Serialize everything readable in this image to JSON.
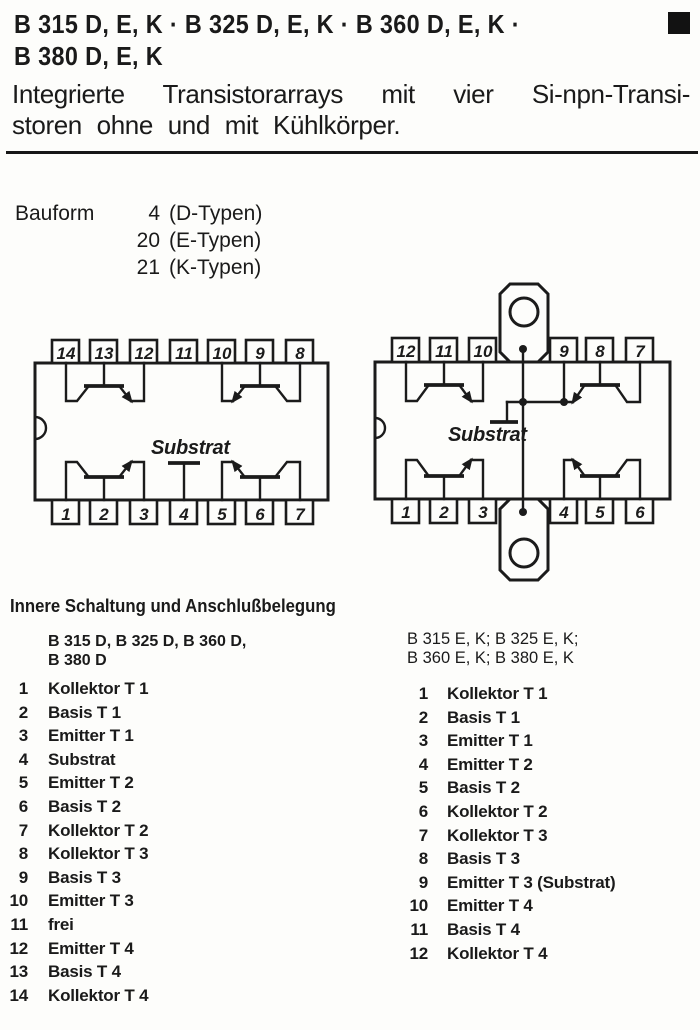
{
  "header": {
    "title_line1": "B 315 D, E, K · B 325 D, E, K · B 360 D, E, K ·",
    "title_line2": "B 380 D, E, K",
    "subtitle_line1": "Integrierte Transistorarrays mit vier Si-npn-Transi-",
    "subtitle_line2": "storen ohne und mit Kühlkörper."
  },
  "bauform": {
    "label": "Bauform",
    "rows": [
      {
        "num": "4",
        "type": "(D-Typen)"
      },
      {
        "num": "20",
        "type": "(E-Typen)"
      },
      {
        "num": "21",
        "type": "(K-Typen)"
      }
    ]
  },
  "diagram_d": {
    "top_pins": [
      "14",
      "13",
      "12",
      "11",
      "10",
      "9",
      "8"
    ],
    "bottom_pins": [
      "1",
      "2",
      "3",
      "4",
      "5",
      "6",
      "7"
    ],
    "substrat_label": "Substrat"
  },
  "diagram_ek": {
    "top_pins": [
      "12",
      "11",
      "10",
      "9",
      "8",
      "7"
    ],
    "bottom_pins": [
      "1",
      "2",
      "3",
      "4",
      "5",
      "6"
    ],
    "substrat_label": "Substrat"
  },
  "pinout": {
    "heading": "Innere Schaltung und Anschlußbelegung",
    "left_column": {
      "header_line1": "B 315 D, B 325 D, B 360 D,",
      "header_line2": "B 380 D",
      "pins": [
        {
          "num": "1",
          "label": "Kollektor T 1"
        },
        {
          "num": "2",
          "label": "Basis T 1"
        },
        {
          "num": "3",
          "label": "Emitter T 1"
        },
        {
          "num": "4",
          "label": "Substrat"
        },
        {
          "num": "5",
          "label": "Emitter T 2"
        },
        {
          "num": "6",
          "label": "Basis T 2"
        },
        {
          "num": "7",
          "label": "Kollektor T 2"
        },
        {
          "num": "8",
          "label": "Kollektor T 3"
        },
        {
          "num": "9",
          "label": "Basis T 3"
        },
        {
          "num": "10",
          "label": "Emitter T 3"
        },
        {
          "num": "11",
          "label": "frei"
        },
        {
          "num": "12",
          "label": "Emitter T 4"
        },
        {
          "num": "13",
          "label": "Basis T 4"
        },
        {
          "num": "14",
          "label": "Kollektor T 4"
        }
      ]
    },
    "right_column": {
      "header_line1": "B 315 E, K; B 325 E, K;",
      "header_line2": "B 360 E, K; B 380 E, K",
      "pins": [
        {
          "num": "1",
          "label": "Kollektor T 1"
        },
        {
          "num": "2",
          "label": "Basis T 1"
        },
        {
          "num": "3",
          "label": "Emitter T 1"
        },
        {
          "num": "4",
          "label": "Emitter T 2"
        },
        {
          "num": "5",
          "label": "Basis T 2"
        },
        {
          "num": "6",
          "label": "Kollektor T 2"
        },
        {
          "num": "7",
          "label": "Kollektor T 3"
        },
        {
          "num": "8",
          "label": "Basis T 3"
        },
        {
          "num": "9",
          "label": "Emitter T 3 (Substrat)"
        },
        {
          "num": "10",
          "label": "Emitter T 4"
        },
        {
          "num": "11",
          "label": "Basis T 4"
        },
        {
          "num": "12",
          "label": "Kollektor T 4"
        }
      ]
    }
  },
  "colors": {
    "ink": "#1b1b1b",
    "paper": "#fdfdfb"
  }
}
